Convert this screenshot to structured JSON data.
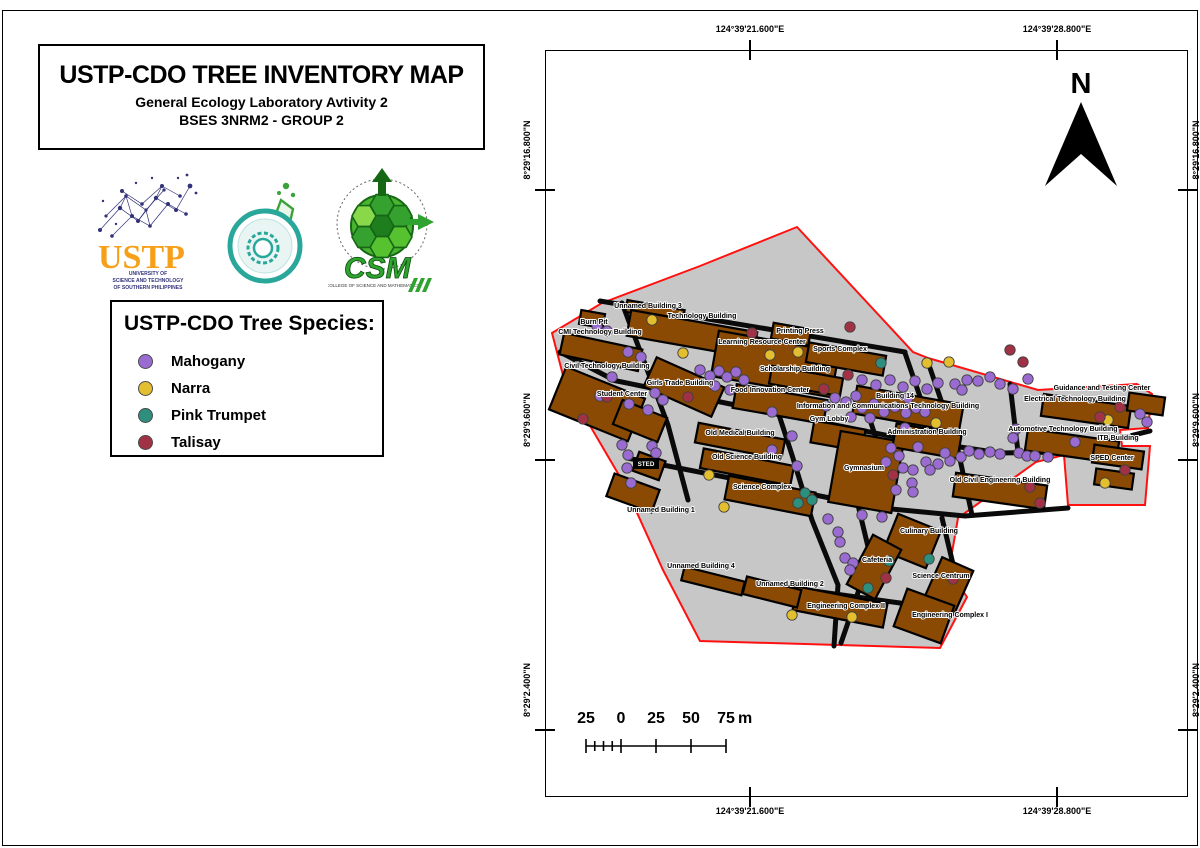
{
  "title_block": {
    "title": "USTP-CDO TREE INVENTORY MAP",
    "subtitle": "General Ecology Laboratory Avtivity 2",
    "group": "BSES 3NRM2 - GROUP 2"
  },
  "logos": {
    "ustp": {
      "acronym": "USTP",
      "line1": "UNIVERSITY OF",
      "line2": "SCIENCE AND TECHNOLOGY",
      "line3": "OF SOUTHERN PHILIPPINES"
    },
    "csm": {
      "acronym": "CSM",
      "caption": "COLLEGE OF SCIENCE AND MATHEMATICS"
    }
  },
  "legend": {
    "title": "USTP-CDO Tree Species:",
    "items": [
      {
        "species": "Mahogany",
        "color": "#9A6BD1"
      },
      {
        "species": "Narra",
        "color": "#E3BE2F"
      },
      {
        "species": "Pink Trumpet",
        "color": "#2E8F7F"
      },
      {
        "species": "Talisay",
        "color": "#A13245"
      }
    ]
  },
  "north": {
    "label": "N"
  },
  "scalebar": {
    "ticks": [
      "25",
      "0",
      "25",
      "50",
      "75"
    ],
    "unit": "m"
  },
  "graticule": {
    "top": [
      "124°39'21.600\"E",
      "124°39'28.800\"E"
    ],
    "bottom": [
      "124°39'21.600\"E",
      "124°39'28.800\"E"
    ],
    "left": [
      "8°29'16.800\"N",
      "8°29'9.600\"N",
      "8°29'2.400\"N"
    ],
    "right": [
      "8°29'16.800\"N",
      "8°29'9.600\"N",
      "8°29'2.400\"N"
    ]
  },
  "map": {
    "colors": {
      "campus": "#C7C7C7",
      "building": "#8A4A04",
      "road": "#0A0A0A",
      "boundary": "#FF1111",
      "dot_stroke": "#404040"
    },
    "species_codes": {
      "M": "Mahogany",
      "N": "Narra",
      "P": "Pink Trumpet",
      "T": "Talisay"
    },
    "boundary": "797,227 913,352 928,358 1038,390 1137,384 1152,394 1148,428 1120,430 1122,446 1150,446 1145,505 1068,505 1064,455 1036,462 958,518 949,570 967,597 940,648 700,641 663,570 623,482 565,383 552,333 602,303 700,266",
    "roads": [
      "M600,301 L905,352",
      "M612,380 L760,410 L900,438 L1000,453 L1065,452 L1150,431",
      "M627,458 L730,478 L830,498 L868,505",
      "M870,507 L965,516 L1068,508",
      "M785,587 L900,603 L952,612",
      "M622,303 L668,425 L688,500",
      "M757,347 L792,455 L812,520 L838,585 L834,646",
      "M905,353 L928,420",
      "M930,368 L958,450 L972,515",
      "M1010,384 L1018,452",
      "M858,505 L870,555 L853,608 L841,643",
      "M942,518 L958,585",
      "M862,396 L880,450",
      "M560,352 L610,378"
    ],
    "buildings": [
      [
        592,
        319,
        24,
        14,
        10,
        "burn-pit"
      ],
      [
        655,
        311,
        58,
        12,
        10,
        "unnamed-building-3"
      ],
      [
        692,
        334,
        128,
        26,
        10,
        "technology-building"
      ],
      [
        601,
        352,
        80,
        22,
        12,
        "cmi-technology-building"
      ],
      [
        597,
        404,
        85,
        46,
        22,
        "civil-technology-building"
      ],
      [
        684,
        387,
        74,
        32,
        24,
        "girls-trade-building"
      ],
      [
        640,
        421,
        48,
        26,
        22,
        "student-center"
      ],
      [
        775,
        364,
        122,
        46,
        10,
        "learning-resource-center"
      ],
      [
        791,
        334,
        38,
        16,
        10,
        "printing-press"
      ],
      [
        846,
        359,
        78,
        20,
        10,
        "sports-complex"
      ],
      [
        806,
        381,
        72,
        18,
        10,
        "scholarship-building"
      ],
      [
        780,
        404,
        92,
        24,
        10,
        "food-innovation-center"
      ],
      [
        908,
        409,
        108,
        28,
        10,
        "ict-building-14"
      ],
      [
        838,
        436,
        52,
        22,
        10,
        "gym-lobby"
      ],
      [
        866,
        472,
        64,
        72,
        10,
        "gymnasium"
      ],
      [
        927,
        441,
        66,
        24,
        10,
        "administration-building"
      ],
      [
        649,
        466,
        28,
        20,
        20,
        "sted"
      ],
      [
        740,
        441,
        88,
        20,
        11,
        "old-medical-building"
      ],
      [
        747,
        467,
        92,
        20,
        11,
        "old-science-building"
      ],
      [
        770,
        496,
        88,
        24,
        11,
        "science-complex"
      ],
      [
        633,
        493,
        48,
        24,
        20,
        "unnamed-building-1"
      ],
      [
        1000,
        491,
        92,
        24,
        8,
        "old-civil-engineering-building"
      ],
      [
        1086,
        411,
        88,
        22,
        8,
        "electrical-technology-building"
      ],
      [
        1146,
        404,
        36,
        18,
        8,
        "guidance-and-testing-center"
      ],
      [
        1072,
        446,
        92,
        22,
        8,
        "automotive-technology-building"
      ],
      [
        1118,
        457,
        50,
        18,
        8,
        "itb-building"
      ],
      [
        1114,
        479,
        38,
        16,
        8,
        "sped-center"
      ],
      [
        912,
        541,
        46,
        40,
        22,
        "culinary-building"
      ],
      [
        874,
        567,
        32,
        56,
        28,
        "cafeteria"
      ],
      [
        948,
        586,
        34,
        48,
        24,
        "science-centrum"
      ],
      [
        840,
        607,
        92,
        24,
        11,
        "engineering-complex-2"
      ],
      [
        924,
        616,
        50,
        40,
        20,
        "engineering-complex-1"
      ],
      [
        713,
        581,
        62,
        14,
        14,
        "unnamed-building-4"
      ],
      [
        772,
        592,
        56,
        18,
        14,
        "unnamed-building-2"
      ]
    ],
    "labels": [
      [
        648,
        308,
        "Unnamed Building 3"
      ],
      [
        702,
        318,
        "Technology Building"
      ],
      [
        594,
        324,
        "Burn Pit"
      ],
      [
        600,
        334,
        "CMI Technology Building"
      ],
      [
        607,
        368,
        "Civil Technology Building"
      ],
      [
        762,
        344,
        "Learning Resource Center"
      ],
      [
        800,
        333,
        "Printing Press"
      ],
      [
        840,
        351,
        "Sports Complex"
      ],
      [
        795,
        371,
        "Scholarship Building"
      ],
      [
        680,
        385,
        "Girls Trade Building"
      ],
      [
        770,
        392,
        "Food Innovation Center"
      ],
      [
        895,
        398,
        "Building 14"
      ],
      [
        888,
        408,
        "Information and Communications Technology Building"
      ],
      [
        622,
        396,
        "Student Center"
      ],
      [
        829,
        421,
        "Gym Lobby"
      ],
      [
        927,
        434,
        "Administration Building"
      ],
      [
        740,
        435,
        "Old Medical Building"
      ],
      [
        747,
        459,
        "Old Science Building"
      ],
      [
        762,
        489,
        "Science Complex"
      ],
      [
        661,
        512,
        "Unnamed Building 1"
      ],
      [
        864,
        470,
        "Gymnasium"
      ],
      [
        1102,
        390,
        "Guidance and Testing Center"
      ],
      [
        1075,
        401,
        "Electrical Technology Building"
      ],
      [
        1063,
        431,
        "Automotive Technology Building"
      ],
      [
        1118,
        440,
        "ITB Building"
      ],
      [
        1000,
        482,
        "Old Civil Engineering Building"
      ],
      [
        1112,
        460,
        "SPED Center"
      ],
      [
        929,
        533,
        "Culinary Building"
      ],
      [
        877,
        562,
        "Cafeteria"
      ],
      [
        941,
        578,
        "Science Centrum"
      ],
      [
        701,
        568,
        "Unnamed Building 4"
      ],
      [
        790,
        586,
        "Unnamed Building 2"
      ],
      [
        846,
        608,
        "Engineering Complex II"
      ],
      [
        950,
        617,
        "Engineering Complex I"
      ]
    ],
    "inverted_label": {
      "x": 646,
      "y": 466,
      "t": "STED"
    },
    "trees": [
      [
        597,
        326,
        "M"
      ],
      [
        607,
        331,
        "M"
      ],
      [
        628,
        352,
        "M"
      ],
      [
        641,
        357,
        "M"
      ],
      [
        612,
        377,
        "M"
      ],
      [
        600,
        396,
        "M"
      ],
      [
        629,
        404,
        "M"
      ],
      [
        655,
        393,
        "M"
      ],
      [
        663,
        400,
        "M"
      ],
      [
        648,
        410,
        "M"
      ],
      [
        622,
        445,
        "M"
      ],
      [
        628,
        455,
        "M"
      ],
      [
        627,
        468,
        "M"
      ],
      [
        631,
        483,
        "M"
      ],
      [
        652,
        446,
        "M"
      ],
      [
        656,
        453,
        "M"
      ],
      [
        700,
        370,
        "M"
      ],
      [
        710,
        376,
        "M"
      ],
      [
        719,
        371,
        "M"
      ],
      [
        727,
        377,
        "M"
      ],
      [
        736,
        372,
        "M"
      ],
      [
        744,
        380,
        "M"
      ],
      [
        715,
        386,
        "M"
      ],
      [
        730,
        390,
        "M"
      ],
      [
        772,
        412,
        "M"
      ],
      [
        772,
        450,
        "M"
      ],
      [
        792,
        436,
        "M"
      ],
      [
        797,
        466,
        "M"
      ],
      [
        828,
        519,
        "M"
      ],
      [
        838,
        532,
        "M"
      ],
      [
        835,
        398,
        "M"
      ],
      [
        846,
        402,
        "M"
      ],
      [
        826,
        406,
        "M"
      ],
      [
        856,
        396,
        "M"
      ],
      [
        862,
        408,
        "M"
      ],
      [
        874,
        404,
        "M"
      ],
      [
        884,
        412,
        "M"
      ],
      [
        895,
        407,
        "M"
      ],
      [
        906,
        413,
        "M"
      ],
      [
        916,
        408,
        "M"
      ],
      [
        908,
        398,
        "M"
      ],
      [
        870,
        418,
        "M"
      ],
      [
        851,
        417,
        "M"
      ],
      [
        925,
        412,
        "M"
      ],
      [
        862,
        380,
        "M"
      ],
      [
        876,
        385,
        "M"
      ],
      [
        890,
        380,
        "M"
      ],
      [
        903,
        387,
        "M"
      ],
      [
        915,
        381,
        "M"
      ],
      [
        927,
        389,
        "M"
      ],
      [
        938,
        383,
        "M"
      ],
      [
        955,
        384,
        "M"
      ],
      [
        967,
        380,
        "M"
      ],
      [
        978,
        381,
        "M"
      ],
      [
        990,
        377,
        "M"
      ],
      [
        1000,
        384,
        "M"
      ],
      [
        1013,
        389,
        "M"
      ],
      [
        1028,
        379,
        "M"
      ],
      [
        962,
        390,
        "M"
      ],
      [
        1147,
        422,
        "M"
      ],
      [
        1140,
        414,
        "M"
      ],
      [
        1016,
        429,
        "M"
      ],
      [
        1013,
        438,
        "M"
      ],
      [
        1019,
        453,
        "M"
      ],
      [
        1027,
        456,
        "M"
      ],
      [
        1035,
        456,
        "M"
      ],
      [
        1048,
        457,
        "M"
      ],
      [
        1075,
        442,
        "M"
      ],
      [
        905,
        428,
        "M"
      ],
      [
        891,
        448,
        "M"
      ],
      [
        899,
        456,
        "M"
      ],
      [
        886,
        462,
        "M"
      ],
      [
        903,
        468,
        "M"
      ],
      [
        913,
        470,
        "M"
      ],
      [
        926,
        462,
        "M"
      ],
      [
        938,
        464,
        "M"
      ],
      [
        950,
        461,
        "M"
      ],
      [
        961,
        457,
        "M"
      ],
      [
        969,
        451,
        "M"
      ],
      [
        979,
        454,
        "M"
      ],
      [
        990,
        452,
        "M"
      ],
      [
        1000,
        454,
        "M"
      ],
      [
        945,
        453,
        "M"
      ],
      [
        918,
        447,
        "M"
      ],
      [
        930,
        470,
        "M"
      ],
      [
        912,
        483,
        "M"
      ],
      [
        913,
        492,
        "M"
      ],
      [
        896,
        490,
        "M"
      ],
      [
        862,
        515,
        "M"
      ],
      [
        882,
        517,
        "M"
      ],
      [
        845,
        558,
        "M"
      ],
      [
        853,
        563,
        "M"
      ],
      [
        850,
        570,
        "M"
      ],
      [
        840,
        542,
        "M"
      ],
      [
        652,
        320,
        "N"
      ],
      [
        683,
        353,
        "N"
      ],
      [
        770,
        355,
        "N"
      ],
      [
        798,
        352,
        "N"
      ],
      [
        927,
        363,
        "N"
      ],
      [
        949,
        362,
        "N"
      ],
      [
        936,
        423,
        "N"
      ],
      [
        709,
        475,
        "N"
      ],
      [
        724,
        507,
        "N"
      ],
      [
        1108,
        420,
        "N"
      ],
      [
        1105,
        483,
        "N"
      ],
      [
        792,
        615,
        "N"
      ],
      [
        852,
        617,
        "N"
      ],
      [
        881,
        363,
        "P"
      ],
      [
        805,
        493,
        "P"
      ],
      [
        798,
        503,
        "P"
      ],
      [
        812,
        500,
        "P"
      ],
      [
        889,
        561,
        "P"
      ],
      [
        868,
        588,
        "P"
      ],
      [
        929,
        559,
        "P"
      ],
      [
        752,
        333,
        "T"
      ],
      [
        850,
        327,
        "T"
      ],
      [
        1010,
        350,
        "T"
      ],
      [
        1023,
        362,
        "T"
      ],
      [
        1120,
        407,
        "T"
      ],
      [
        1100,
        417,
        "T"
      ],
      [
        848,
        375,
        "T"
      ],
      [
        824,
        389,
        "T"
      ],
      [
        607,
        397,
        "T"
      ],
      [
        583,
        419,
        "T"
      ],
      [
        688,
        397,
        "T"
      ],
      [
        893,
        475,
        "T"
      ],
      [
        886,
        578,
        "T"
      ],
      [
        953,
        579,
        "T"
      ],
      [
        1030,
        487,
        "T"
      ],
      [
        1040,
        503,
        "T"
      ],
      [
        1125,
        470,
        "T"
      ]
    ]
  }
}
